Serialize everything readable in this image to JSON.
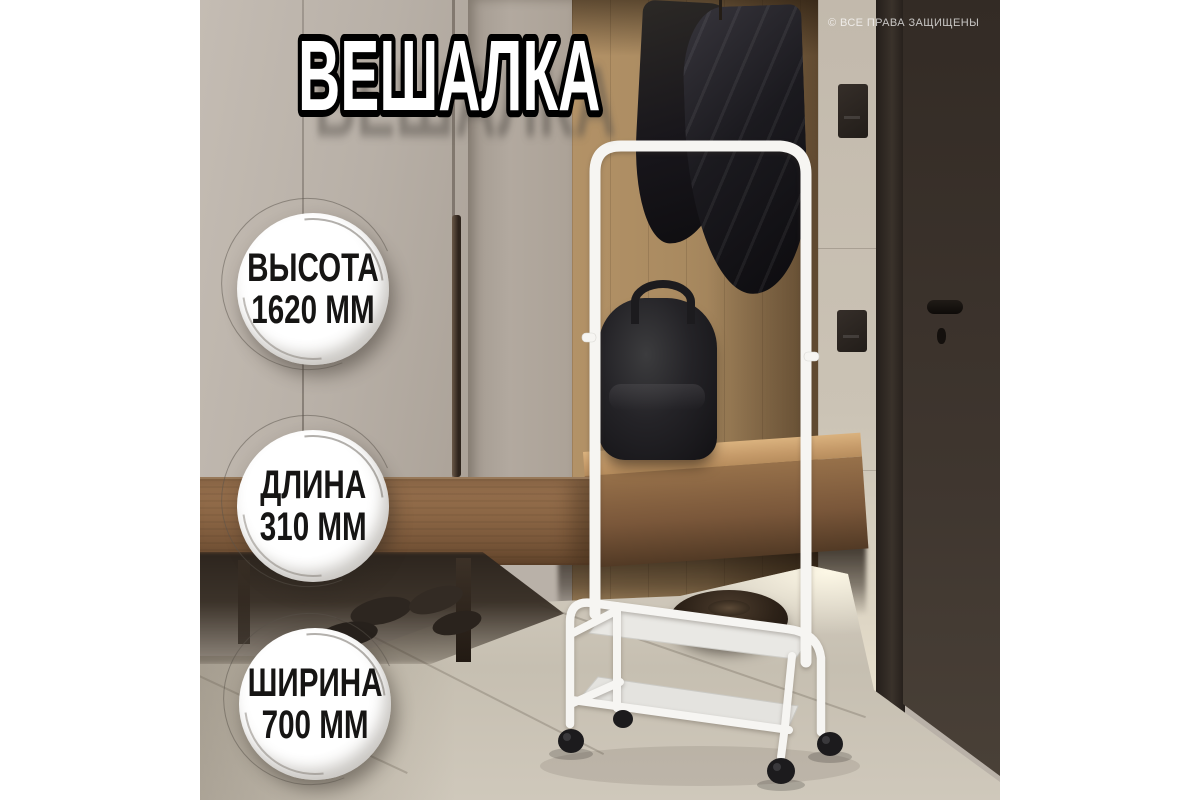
{
  "title": "ВЕШАЛКА",
  "watermark": "© ВСЕ ПРАВА ЗАЩИЩЕНЫ",
  "badges": [
    {
      "label": "ВЫСОТА",
      "value": "1620 ММ"
    },
    {
      "label": "ДЛИНА",
      "value": "310 ММ"
    },
    {
      "label": "ШИРИНА",
      "value": "700 ММ"
    }
  ],
  "colors": {
    "title_fill": "#ffffff",
    "title_outline": "#000000",
    "badge_bg": "#ffffff",
    "badge_text": "#161514",
    "rack_tube": "#f6f5f2",
    "wheel": "#1c1b1d",
    "watermark_text": "#ffffff"
  }
}
